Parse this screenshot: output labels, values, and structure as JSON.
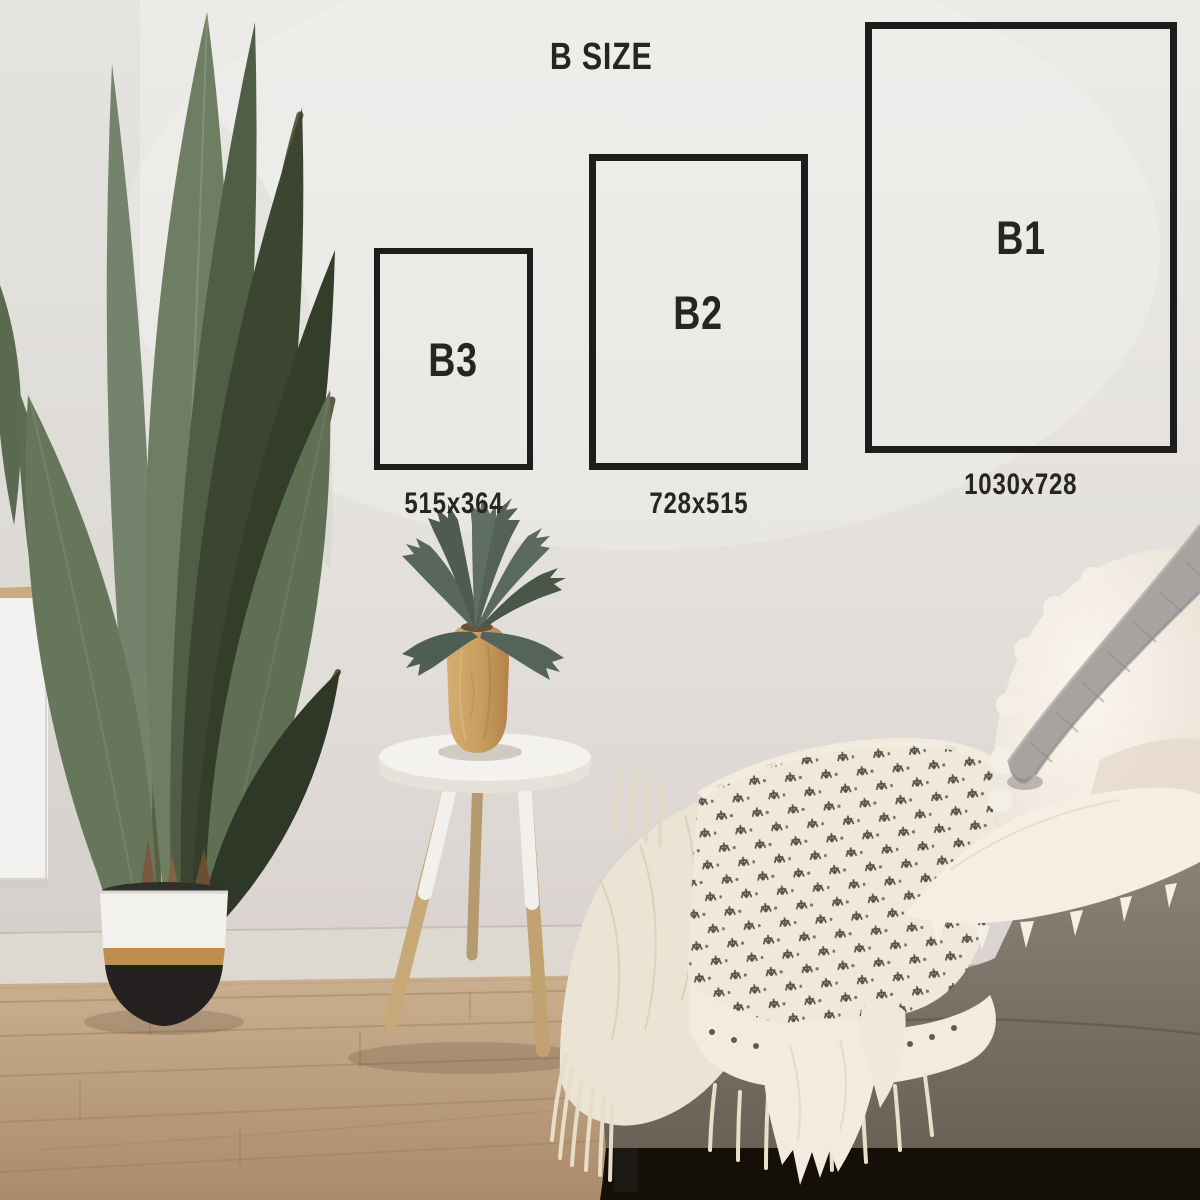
{
  "overlay": {
    "title": "B SIZE",
    "sizes": [
      {
        "label": "B3",
        "dimensions": "515x364"
      },
      {
        "label": "B2",
        "dimensions": "728x515"
      },
      {
        "label": "B1",
        "dimensions": "1030x728"
      }
    ],
    "frame_color": "#1d1d1d",
    "text_color": "#262524"
  },
  "scene": {
    "objects": [
      "white-wall",
      "wood-floor",
      "bird-of-paradise-plant",
      "two-tone-planter",
      "white-sideboard",
      "tripod-stool",
      "wooden-vase",
      "staghorn-fern",
      "grey-sofa",
      "patterned-throw-blanket",
      "cream-muslin-blanket",
      "white-fur-throw",
      "grey-knit-pillow",
      "white-sherpa-pillow"
    ],
    "colors": {
      "wall": "#e7e4e0",
      "floor_wood": "#bda083",
      "leaf_green_dark": "#39432f",
      "leaf_green": "#5f6f53",
      "pot_white": "#f3f1ed",
      "pot_gold": "#bf8f4e",
      "pot_black": "#242120",
      "stool_white": "#f5f3ef",
      "stool_wood": "#c7a877",
      "vase_wood": "#c79e5f",
      "sofa_taupe": "#81786d",
      "blanket_cream": "#f0e9db",
      "blanket_motif": "#46413a",
      "knit_grey": "#a3a09d"
    }
  }
}
